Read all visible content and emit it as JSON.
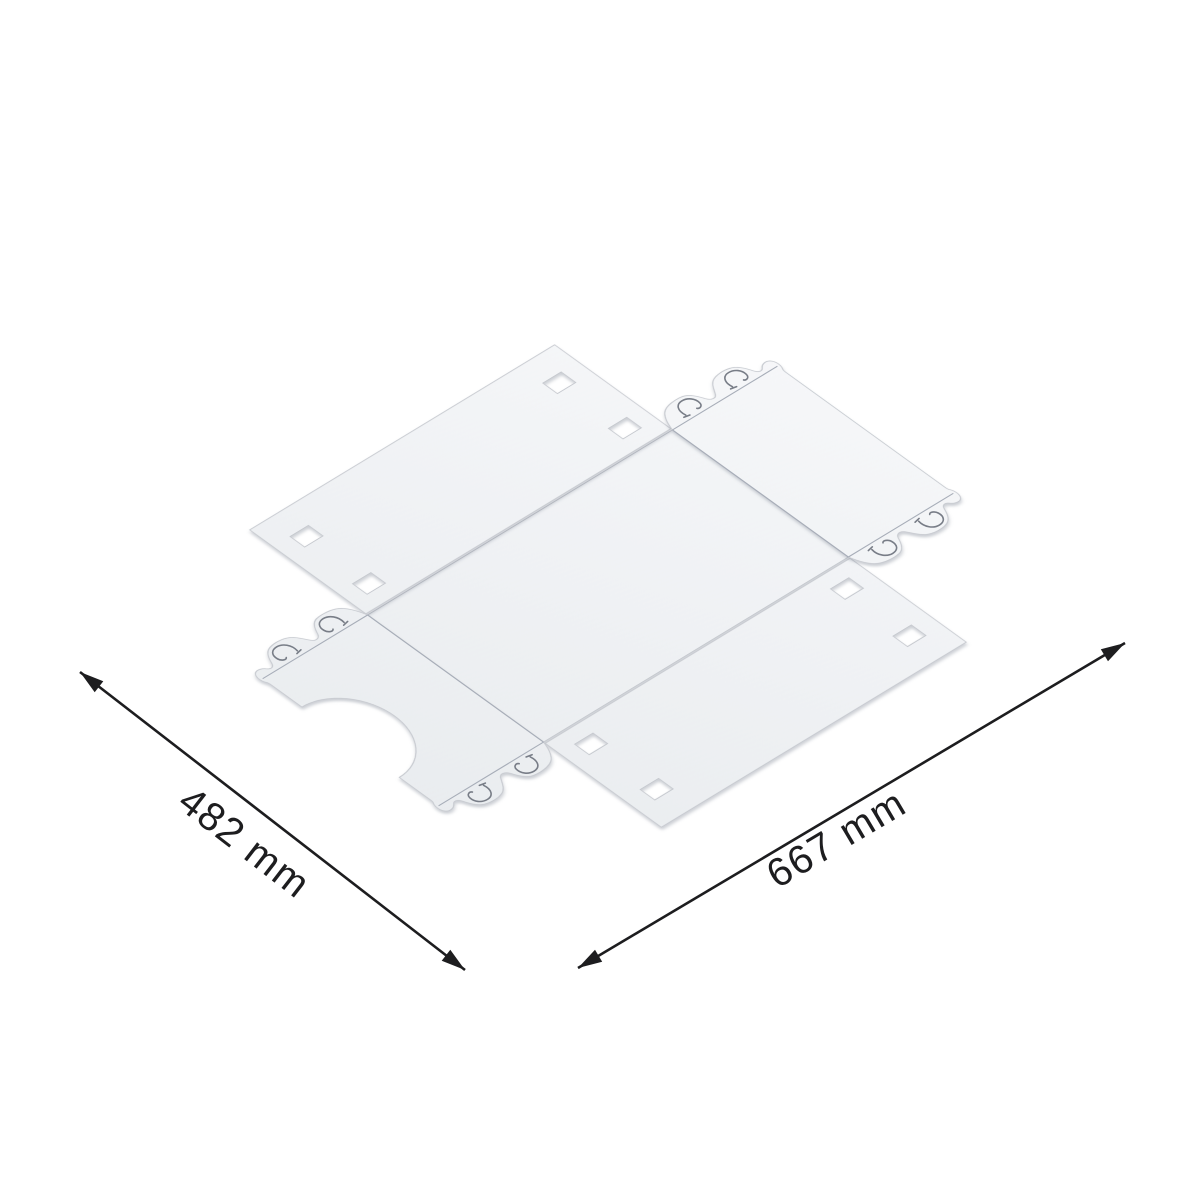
{
  "scene": {
    "name": "packaging-dieline-isometric-preview",
    "view": "isometric render of a flat die-cut box blank on white background",
    "pieces": [
      {
        "id": "top-side-panel",
        "description": "flat side panel with 4 rectangular lock slots"
      },
      {
        "id": "base-panel",
        "description": "central base panel"
      },
      {
        "id": "bottom-side-panel",
        "description": "flat side panel with 4 rectangular lock slots"
      },
      {
        "id": "right-end-flap",
        "description": "end flap with 2 locking ears per end and 4 hook slits, fold creases at base and ear lines"
      },
      {
        "id": "left-end-flap",
        "description": "end flap with 2 locking ears per end, 4 hook slits and a semicircular thumb notch on outer edge"
      }
    ],
    "slot_count": 8,
    "hook_slit_count": 8
  },
  "dimensions": {
    "width": {
      "label": "667 mm",
      "value": 667,
      "unit": "mm"
    },
    "depth": {
      "label": "482 mm",
      "value": 482,
      "unit": "mm"
    }
  },
  "theme": {
    "background": "#ffffff",
    "sheet_fill_dark": "#e9ecef",
    "sheet_fill_light": "#f6f7f9",
    "sheet_edge": "#c6c9cf",
    "crease_line": "#a7adb8",
    "slit_line": "#787d87",
    "shadow": "#7e8694",
    "dimension_line": "#1d1d1f"
  }
}
